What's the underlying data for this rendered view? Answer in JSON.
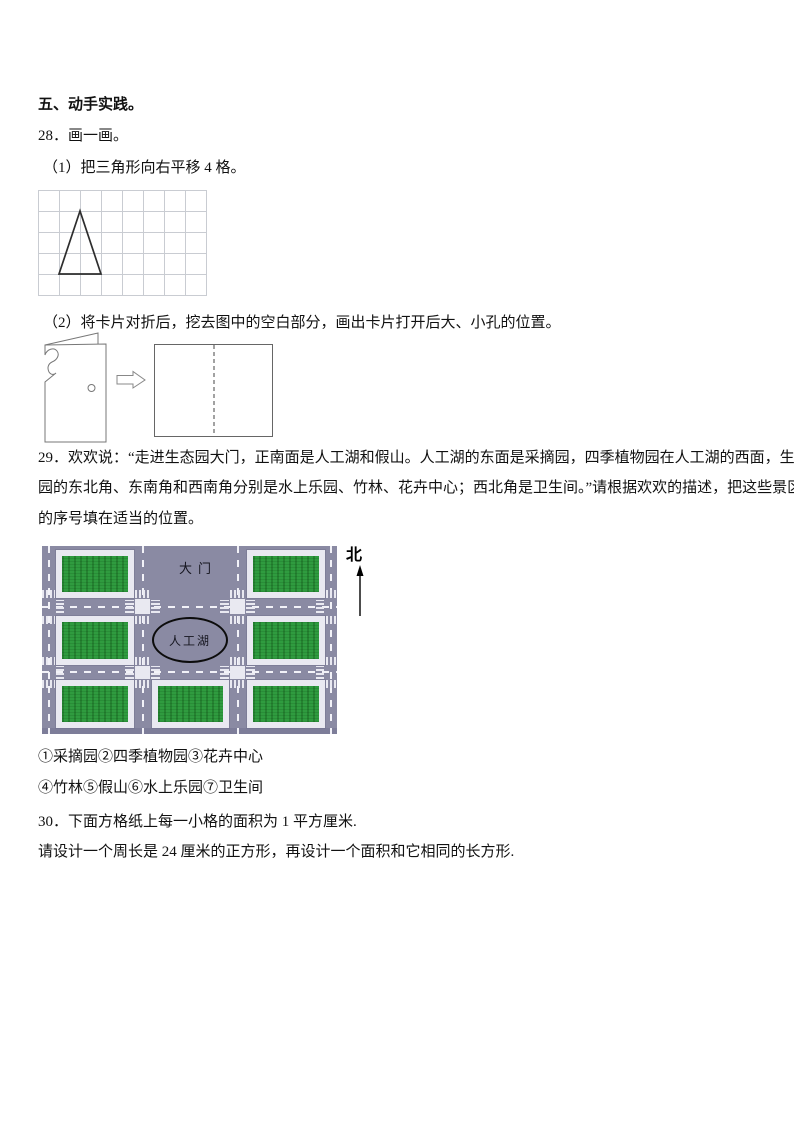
{
  "page": {
    "section5_title": "五、动手实践。",
    "q28": {
      "number_label": "28．画一画。",
      "part1": "（1）把三角形向右平移 4 格。",
      "part2": "（2）将卡片对折后，挖去图中的空白部分，画出卡片打开后大、小孔的位置。"
    },
    "q29": {
      "lines": [
        "29．欢欢说：“走进生态园大门，正南面是人工湖和假山。人工湖的东面是采摘园，四季植物园在人工湖的西面，生态",
        "园的东北角、东南角和西南角分别是水上乐园、竹林、花卉中心；西北角是卫生间。”请根据欢欢的描述，把这些景区",
        "的序号填在适当的位置。"
      ],
      "map": {
        "gate_label": "大门",
        "lake_label": "人工湖",
        "north_label": "北",
        "colors": {
          "road": "#8a8aa3",
          "sidewalk": "#e9e9f1",
          "grass": "#2f9b3f"
        }
      },
      "legend_line1": "①采摘园②四季植物园③花卉中心",
      "legend_line2": "④竹林⑤假山⑥水上乐园⑦卫生间"
    },
    "q30": {
      "line1": "30．下面方格纸上每一小格的面积为 1 平方厘米.",
      "line2": "请设计一个周长是 24 厘米的正方形，再设计一个面积和它相同的长方形."
    }
  }
}
